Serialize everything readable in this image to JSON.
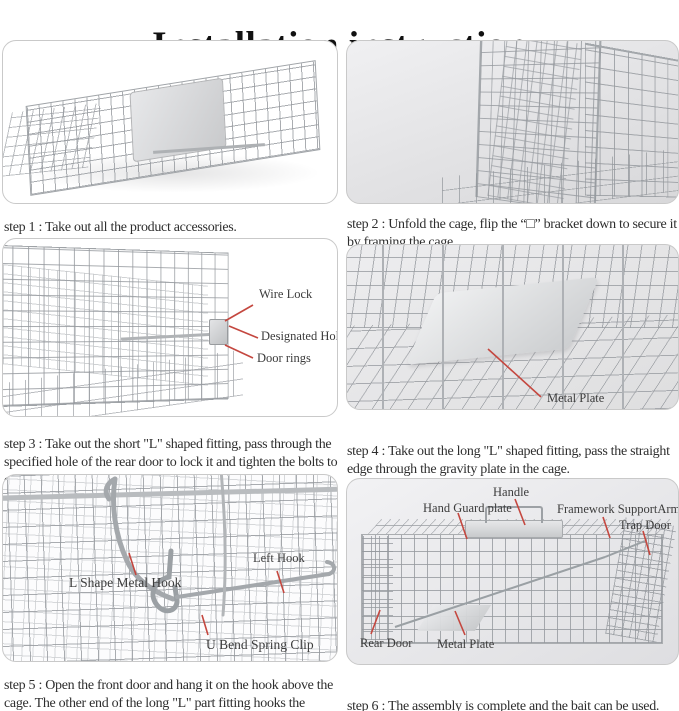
{
  "title": "Installation instruction",
  "steps": [
    {
      "caption": "step 1 : Take out all the product accessories.",
      "labels": []
    },
    {
      "caption": "step 2 : Unfold the cage, flip the “□” bracket down to secure it by framing the cage.",
      "labels": []
    },
    {
      "caption": "step 3 : Take out the short \"L\" shaped fitting, pass through the specified hole of the rear door to lock it and tighten the bolts to ensure that the rear door cannot be opened.",
      "labels": [
        "Wire Lock",
        "Designated Hol",
        "Door rings"
      ]
    },
    {
      "caption": "step 4 : Take out the long \"L\" shaped fitting, pass the straight edge through the gravity plate in the cage.",
      "labels": [
        "Metal Plate"
      ]
    },
    {
      "caption": "step 5 : Open the front door and hang it on the hook above the cage. The other end of the long \"L\" part fitting hooks the outside hook of the front door.",
      "labels": [
        "L Shape Metal Hook",
        "Left Hook",
        "U Bend Spring Clip"
      ]
    },
    {
      "caption": "step 6 : The assembly is complete and the bait can be used.",
      "labels": [
        "Handle",
        "Hand Guard plate",
        "Framework SupportArm",
        "Trap Door",
        "Rear Door",
        "Metal Plate"
      ]
    }
  ],
  "colors": {
    "annotation_line": "#c4473f",
    "caption_text": "#2e2e2e",
    "label_text": "#3c3c3c",
    "panel_border": "#c9c9c9"
  }
}
